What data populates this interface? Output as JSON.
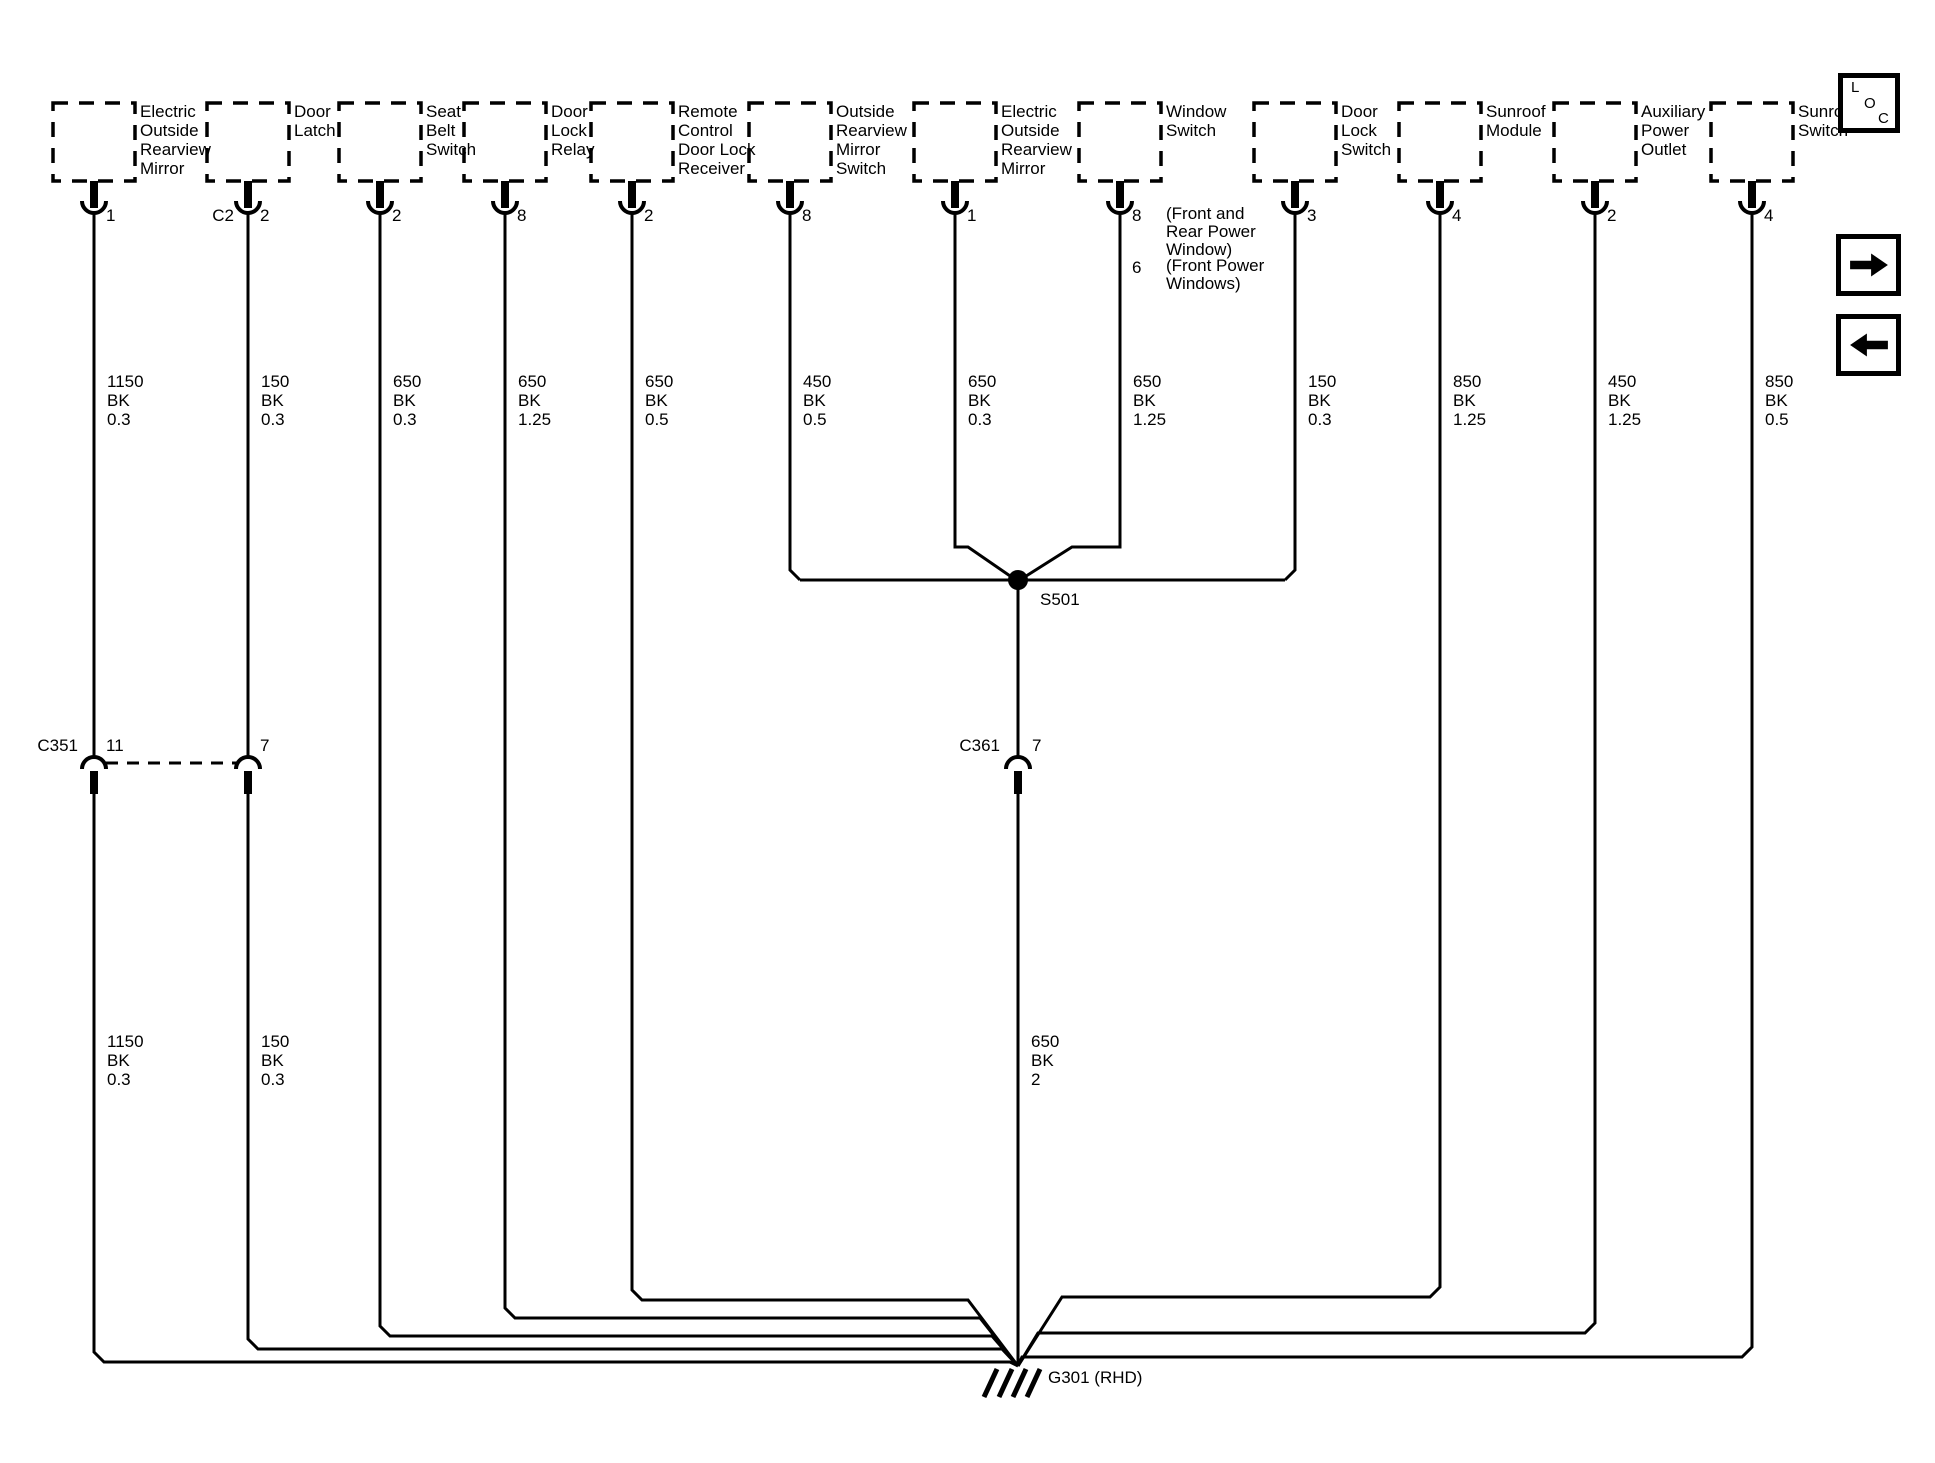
{
  "colors": {
    "wire": "#000000",
    "background": "#ffffff"
  },
  "components": [
    {
      "name": "Electric\nOutside\nRearview\nMirror",
      "pin": "1",
      "wire_spec": "1150\nBK\n0.3"
    },
    {
      "name": "Door\nLatch",
      "connector": "C2",
      "pin": "2",
      "wire_spec": "150\nBK\n0.3"
    },
    {
      "name": "Seat\nBelt\nSwitch",
      "pin": "2",
      "wire_spec": "650\nBK\n0.3"
    },
    {
      "name": "Door\nLock\nRelay",
      "pin": "8",
      "wire_spec": "650\nBK\n1.25"
    },
    {
      "name": "Remote\nControl\nDoor Lock\nReceiver",
      "pin": "2",
      "wire_spec": "650\nBK\n0.5"
    },
    {
      "name": "Outside\nRearview\nMirror\nSwitch",
      "pin": "8",
      "wire_spec": "450\nBK\n0.5"
    },
    {
      "name": "Electric\nOutside\nRearview\nMirror",
      "pin": "1",
      "wire_spec": "650\nBK\n0.3"
    },
    {
      "name": "Window\nSwitch",
      "pin": "8",
      "pin_note": "(Front and\nRear Power\nWindow)",
      "pin_alt": "6",
      "pin_alt_note": "(Front Power\nWindows)",
      "wire_spec": "650\nBK\n1.25"
    },
    {
      "name": "Door\nLock\nSwitch",
      "pin": "3",
      "wire_spec": "150\nBK\n0.3"
    },
    {
      "name": "Sunroof\nModule",
      "pin": "4",
      "wire_spec": "850\nBK\n1.25"
    },
    {
      "name": "Auxiliary\nPower\nOutlet",
      "pin": "2",
      "wire_spec": "450\nBK\n1.25"
    },
    {
      "name": "Sunroof\nSwitch",
      "pin": "4",
      "wire_spec": "850\nBK\n0.5"
    }
  ],
  "inline_connectors": {
    "c351": {
      "label": "C351",
      "pin_a": "11",
      "pin_b": "7"
    },
    "c361": {
      "label": "C361",
      "pin": "7"
    }
  },
  "lower_wire_specs": {
    "mirror_wire": "1150\nBK\n0.3",
    "door_latch_wire": "150\nBK\n0.3",
    "ground_wire": "650\nBK\n2"
  },
  "splice": {
    "label": "S501"
  },
  "ground": {
    "label": "G301 (RHD)"
  },
  "nav": {
    "loc": {
      "l": "L",
      "o": "O",
      "c": "C"
    }
  }
}
